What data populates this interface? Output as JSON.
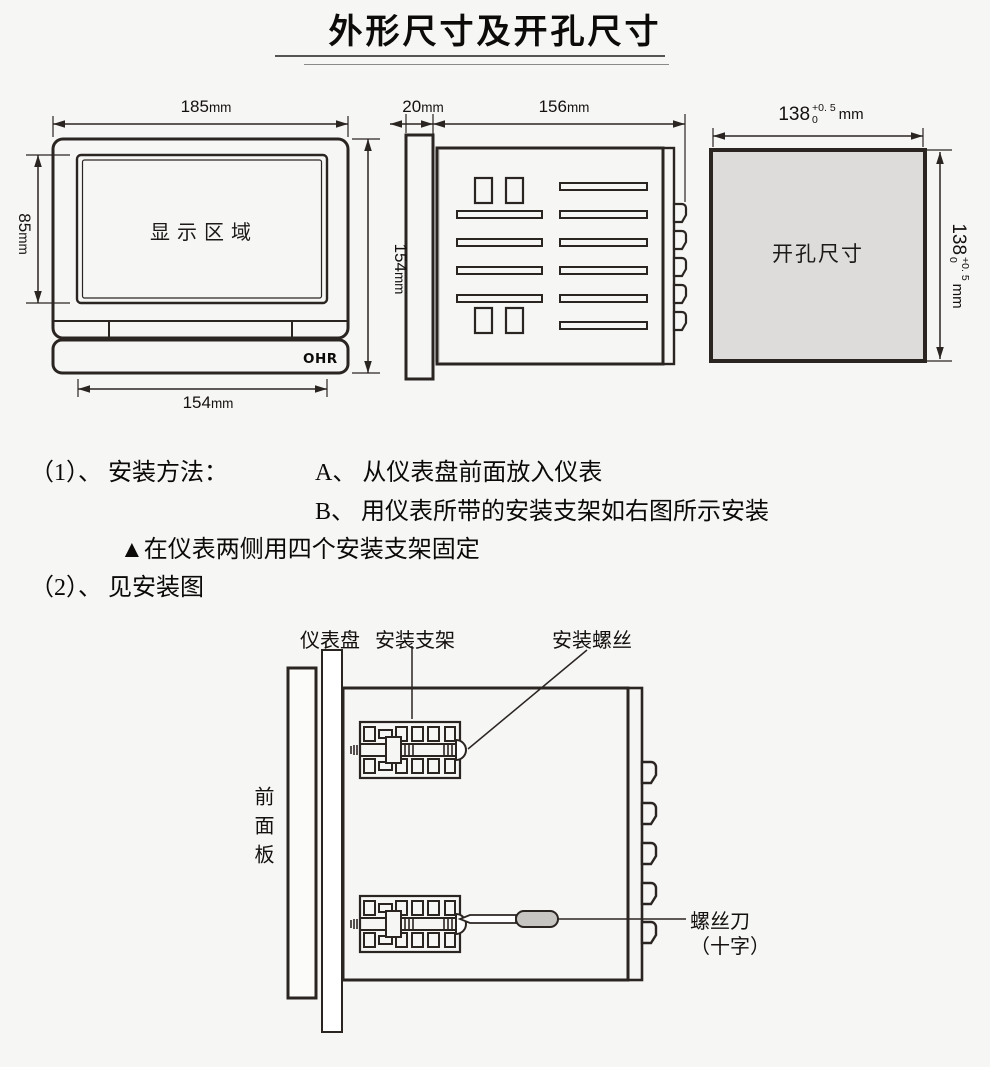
{
  "title": "外形尺寸及开孔尺寸",
  "front_view": {
    "display_area_label": "显示区域",
    "brand": "OHR",
    "dim_width_top": {
      "value": "185",
      "unit": "mm"
    },
    "dim_screen_height": {
      "value": "85",
      "unit": "mm"
    },
    "dim_height_right": {
      "value": "154",
      "unit": "mm"
    },
    "dim_width_bottom": {
      "value": "154",
      "unit": "mm"
    }
  },
  "side_view": {
    "dim_bezel_depth": {
      "value": "20",
      "unit": "mm"
    },
    "dim_body_depth": {
      "value": "156",
      "unit": "mm"
    }
  },
  "cutout": {
    "label": "开孔尺寸",
    "dim": {
      "base": "138",
      "tol_plus": "+0. 5",
      "tol_minus": "0",
      "unit": "mm"
    }
  },
  "instructions": {
    "item1_label": "（1）、 安装方法：",
    "item1_a": "A、 从仪表盘前面放入仪表",
    "item1_b": "B、 用仪表所带的安装支架如右图所示安装",
    "note": "▲在仪表两侧用四个安装支架固定",
    "item2_label": "（2）、 见安装图"
  },
  "install_figure": {
    "labels": {
      "panel": "仪表盘",
      "bracket": "安装支架",
      "screw": "安装螺丝",
      "front_panel": "前面板",
      "screwdriver": "螺丝刀",
      "screwdriver_type": "（十字）"
    }
  },
  "colors": {
    "background": "#f6f6f5",
    "line": "#2b2522",
    "cutout_fill": "#dddcda",
    "screwdriver_handle": "#c6c5c2"
  }
}
